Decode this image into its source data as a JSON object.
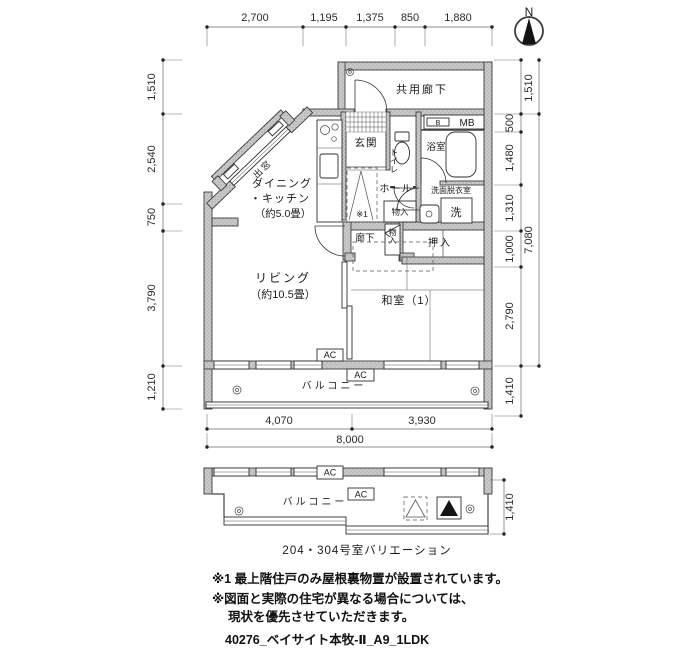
{
  "compass": {
    "north": "N"
  },
  "dimensions": {
    "top": [
      "2,700",
      "1,195",
      "1,375",
      "850",
      "1,880"
    ],
    "left": [
      "1,510",
      "2,540",
      "750",
      "3,790",
      "1,210"
    ],
    "right": [
      "1,510",
      "500",
      "1,480",
      "1,310",
      "1,000",
      "2,790",
      "1,410"
    ],
    "right_overall": "7,080",
    "bottom": [
      "4,070",
      "3,930"
    ],
    "bottom_overall": "8,000",
    "variation_right": "1,410"
  },
  "rooms": {
    "common_corridor": "共用廊下",
    "meter_box": "MB",
    "meter_box_b": "B",
    "entrance": "玄関",
    "toilet": "トイレ",
    "bath": "浴室",
    "washroom": "洗面脱衣室",
    "washer": "洗",
    "hall": "ホール",
    "hall_storage": "物入",
    "corridor": "廊下",
    "corridor_storage": "物入",
    "closet": "押入",
    "dining_line1": "ダイニング",
    "dining_line2": "・キッチン",
    "dining_line3": "（約5.0畳）",
    "bay_window": "出窓",
    "living_line1": "リビング",
    "living_line2": "（約10.5畳）",
    "japanese_room": "和室（1）",
    "balcony": "バルコニー",
    "ac_unit": "AC",
    "attic_ref": "※1"
  },
  "variation": {
    "balcony": "バルコニー",
    "ac_unit": "AC",
    "caption": "204・304号室バリエーション"
  },
  "notes": {
    "line1": "※1 最上階住戸のみ屋根裏物置が設置されています。",
    "line2": "※図面と実際の住宅が異なる場合については、",
    "line3": "現状を優先させていただきます。"
  },
  "footer": {
    "drawing_code": "40276_ベイサイト本牧-Ⅱ_A9_1LDK"
  }
}
